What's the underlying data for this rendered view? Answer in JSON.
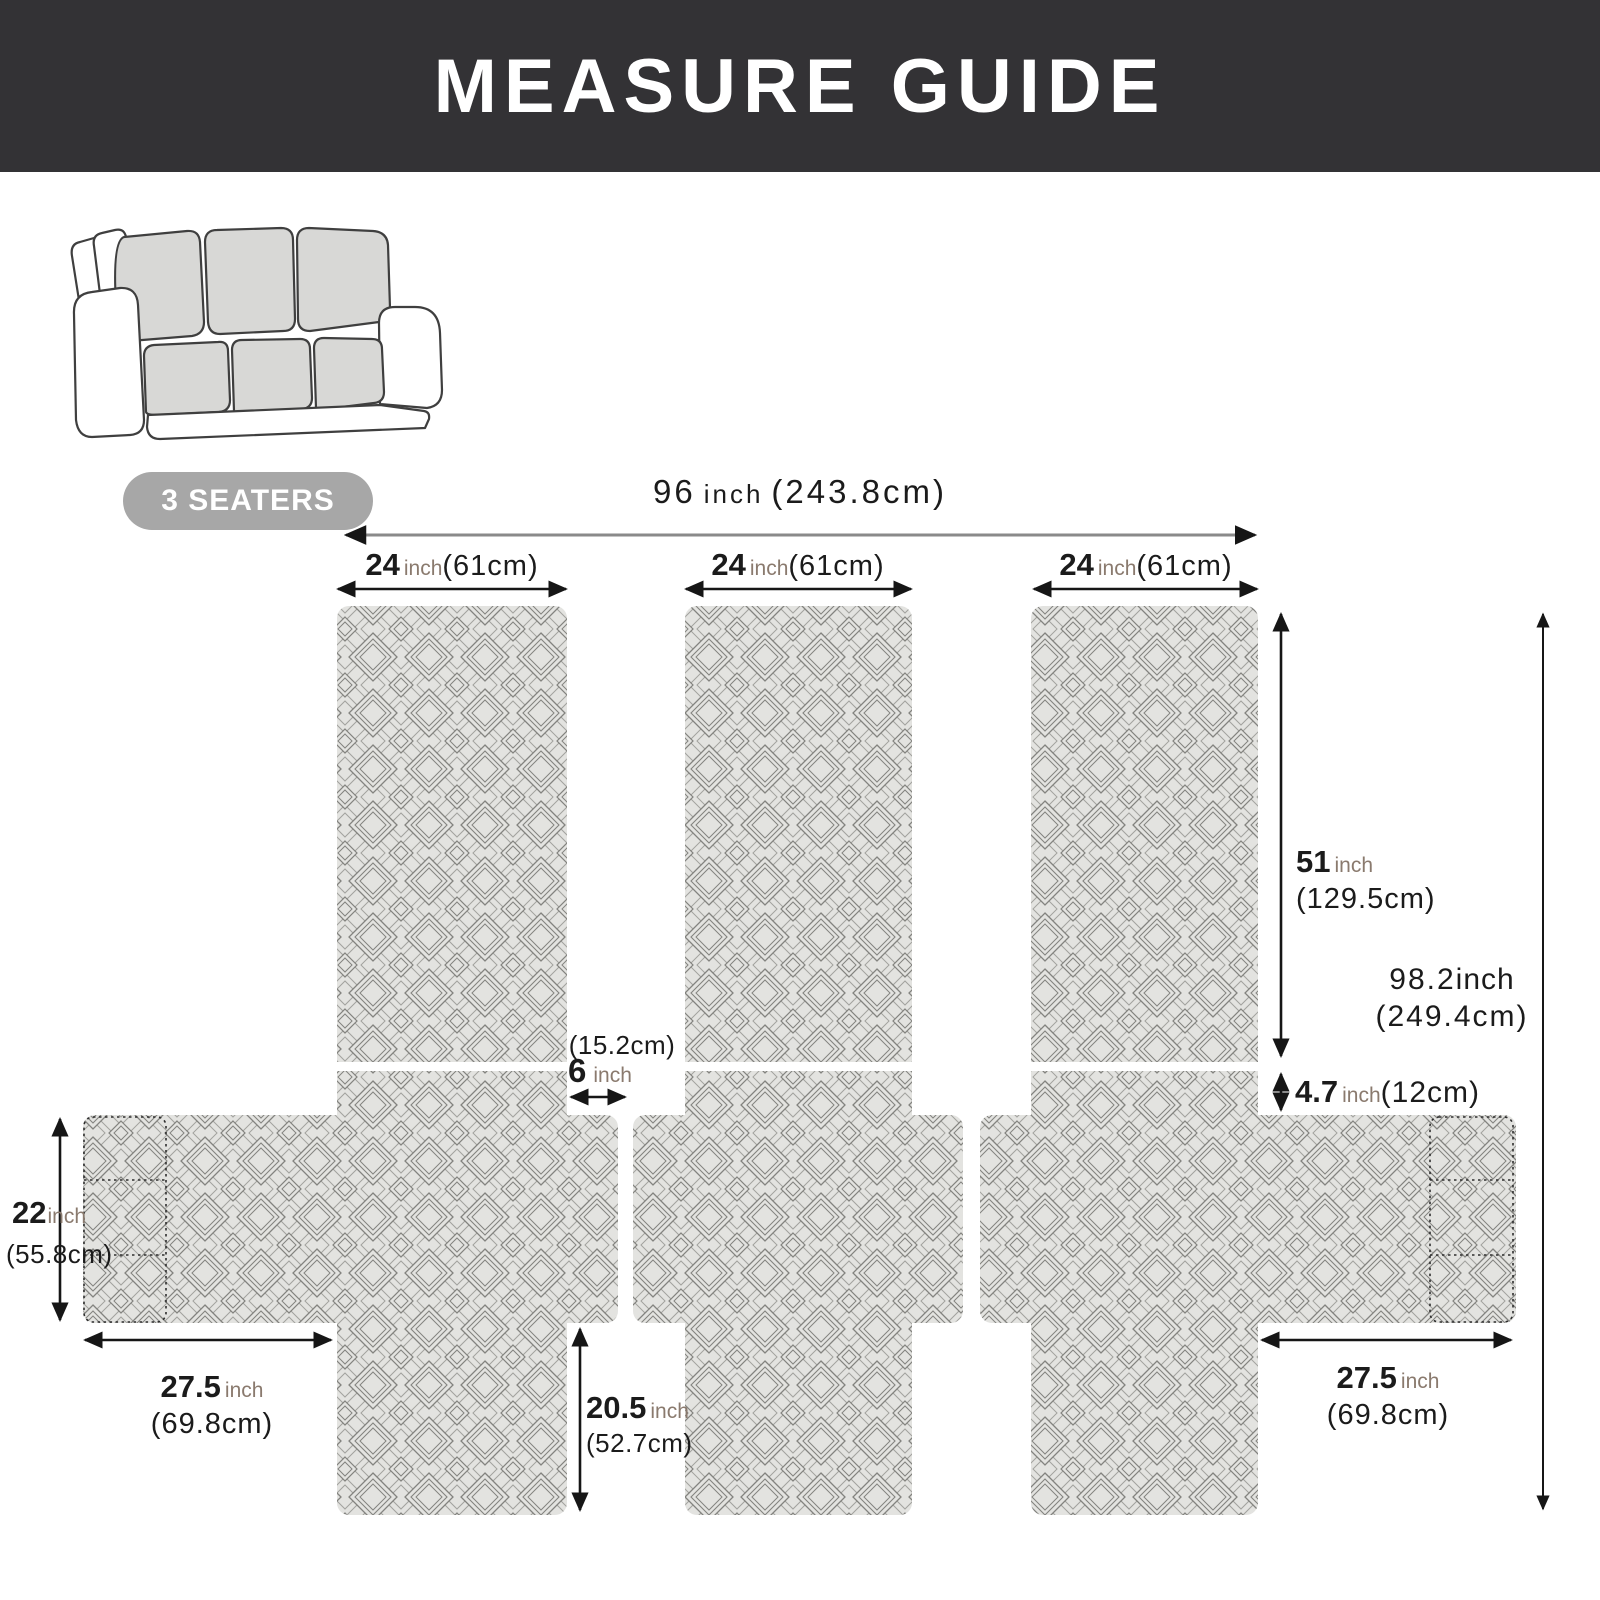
{
  "header": {
    "title": "MEASURE GUIDE"
  },
  "badge": {
    "label": "3 SEATERS"
  },
  "colors": {
    "header_bg": "#333235",
    "badge_bg": "#a7a7a7",
    "fabric": "#e3e3e0",
    "pattern_line": "#83837f",
    "unit_text": "#8a7a6e",
    "arrow": "#161616"
  },
  "icons": {
    "sofa": "three-seat-sofa-line-art"
  },
  "measurements": {
    "total_width": {
      "value": "96",
      "unit": "inch",
      "cm": "(243.8cm)"
    },
    "panel_widths": [
      {
        "value": "24",
        "unit": "inch",
        "cm": "(61cm)"
      },
      {
        "value": "24",
        "unit": "inch",
        "cm": "(61cm)"
      },
      {
        "value": "24",
        "unit": "inch",
        "cm": "(61cm)"
      }
    ],
    "back_height": {
      "value": "51",
      "unit": "inch",
      "cm": "(129.5cm)"
    },
    "total_length": {
      "value": "98.2",
      "unit": "inch",
      "cm": "(249.4cm)"
    },
    "strip_gap": {
      "value": "6",
      "unit": "inch",
      "cm": "(15.2cm)"
    },
    "seat_back_gap": {
      "value": "4.7",
      "unit": "inch",
      "cm": "(12cm)"
    },
    "side_height": {
      "value": "22",
      "unit": "inch",
      "cm": "(55.8cm)"
    },
    "side_width_left": {
      "value": "27.5",
      "unit": "inch",
      "cm": "(69.8cm)"
    },
    "front_drop": {
      "value": "20.5",
      "unit": "inch",
      "cm": "(52.7cm)"
    },
    "side_width_right": {
      "value": "27.5",
      "unit": "inch",
      "cm": "(69.8cm)"
    }
  }
}
